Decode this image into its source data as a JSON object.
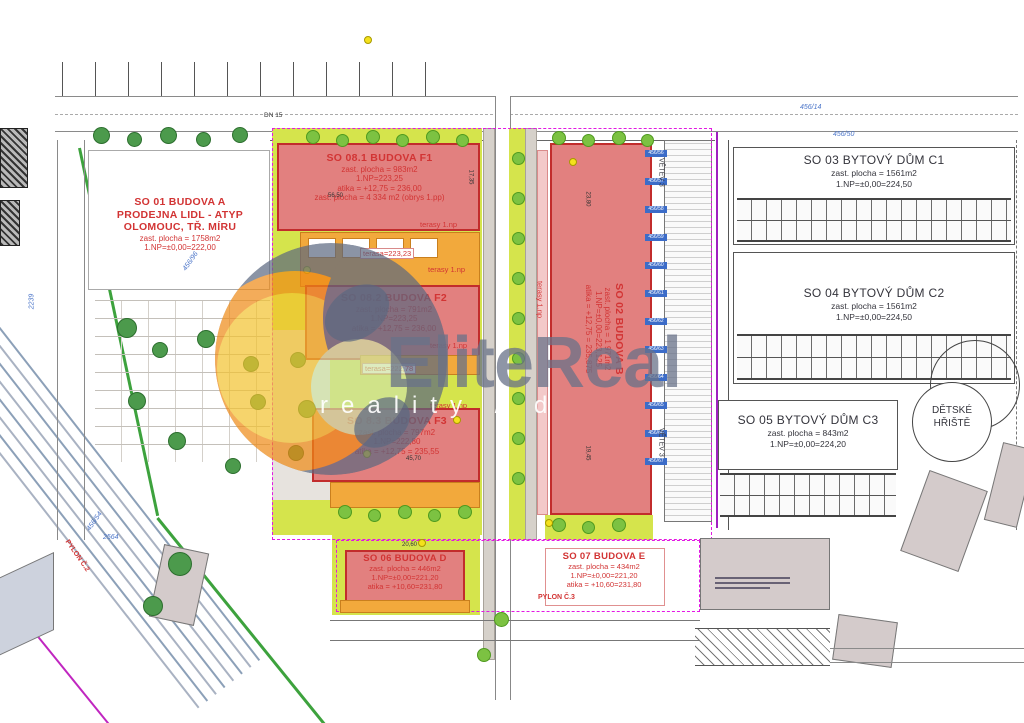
{
  "watermark": {
    "brand": "EliteReal",
    "subtitle": "reality / d"
  },
  "buildings": {
    "so01": {
      "title": "SO 01 BUDOVA A",
      "line2": "PRODEJNA LIDL - ATYP",
      "line3": "OLOMOUC, TŘ. MÍRU",
      "line4": "zast. plocha = 1758m2",
      "line5": "1.NP=±0,00=222,00"
    },
    "so081": {
      "title": "SO 08.1 BUDOVA F1",
      "line2": "zast. plocha = 983m2",
      "line3": "1.NP=223,25",
      "line4": "atika = +12,75 = 236,00",
      "line5": "zast. plocha = 4 334 m2 (obrys 1.pp)"
    },
    "so082": {
      "title": "SO 08.2 BUDOVA F2",
      "line2": "zast. plocha = 791m2",
      "line3": "1.NP=223,25",
      "line4": "atika = +12,75 = 236,00"
    },
    "so83": {
      "title": "SO 8.3 BUDOVA F3",
      "line2": "zast. plocha = 797m2",
      "line3": "1.NP=222,80",
      "line4": "atika = +12,75 = 235,55"
    },
    "so02": {
      "title": "SO 02 BUDOVA B",
      "line2": "zast. plocha = 1 971m2",
      "line3": "1.NP=±0,00=223,125",
      "line4": "atika = +12,75 = 235,875"
    },
    "so03": {
      "title": "SO 03 BYTOVÝ DŮM C1",
      "line2": "zast. plocha = 1561m2",
      "line3": "1.NP=±0,00=224,50"
    },
    "so04": {
      "title": "SO 04 BYTOVÝ DŮM C2",
      "line2": "zast. plocha = 1561m2",
      "line3": "1.NP=±0,00=224,50"
    },
    "so05": {
      "title": "SO 05 BYTOVÝ DŮM C3",
      "line2": "zast. plocha = 843m2",
      "line3": "1.NP=±0,00=224,20"
    },
    "so06": {
      "title": "SO 06 BUDOVA D",
      "line2": "zast. plocha = 446m2",
      "line3": "1.NP=±0,00=221,20",
      "line4": "atika = +10,60=231,80"
    },
    "so07": {
      "title": "SO 07 BUDOVA E",
      "line2": "zast. plocha = 434m2",
      "line3": "1.NP=±0,00=221,20",
      "line4": "atika = +10,60=231,80"
    }
  },
  "annotations": {
    "terasa1": "terasa=223,23",
    "terasa2": "terasa=222,78",
    "terasy": "terasy 1.np",
    "dn15": "DN 15",
    "pylon2": "PYLON Č.2",
    "pylon3": "PYLON Č.3",
    "vetev3": "VĚTEV 3",
    "detske1": "DĚTSKÉ",
    "detske2": "HŘIŠTĚ"
  },
  "parcels": {
    "p1": "456/14",
    "p2": "456/50",
    "p3": "456/54",
    "p4": "456/96",
    "p5": "2239",
    "p6": "2564",
    "right": [
      "456/56",
      "456/57",
      "456/58",
      "456/59",
      "456/60",
      "456/61",
      "456/62",
      "456/63",
      "456/64",
      "456/65",
      "456/66",
      "456/67"
    ]
  },
  "dimensions": {
    "d1": "56,50",
    "d2": "45,70",
    "d3": "23,80",
    "d4": "19,45",
    "d5": "20,60",
    "d6": "17,35"
  },
  "colors": {
    "building_fill": "#e2807f",
    "building_border": "#c22c2c",
    "label_red": "#d23434",
    "ground_lime": "#d5e44c",
    "terrace_orange": "#f2a93c",
    "boundary_magenta": "#e318e3",
    "parcel_blue": "#4a74c8",
    "boundary_green": "#3da23d",
    "watermark_gray": "#68728a"
  }
}
